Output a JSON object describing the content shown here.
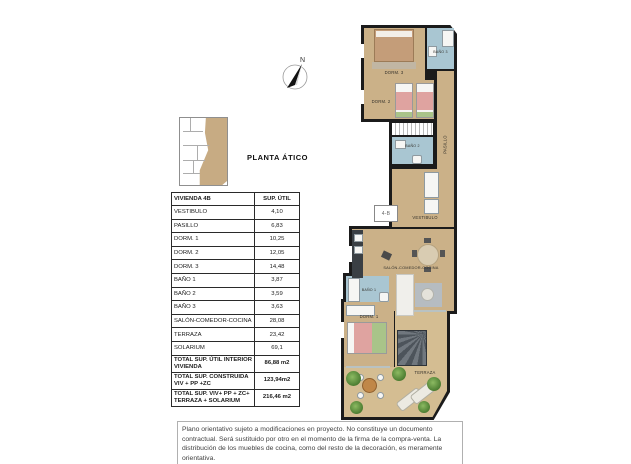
{
  "title": "PLANTA ÁTICO",
  "floorplan": {
    "compass_label": "N",
    "unit_label": "4-B",
    "rooms": {
      "dorm3": "DORM. 3",
      "bano3": "BAÑO 3",
      "dorm2": "DORM. 2",
      "bano2": "BAÑO 2",
      "pasillo": "PASILLO",
      "vestibulo": "VESTIBULO",
      "salon": "SALÓN-COMEDOR-COCINA",
      "bano1": "BAÑO 1",
      "dorm1": "DORM. 1",
      "terraza": "TERRAZA"
    },
    "colors": {
      "wall": "#1b1b1b",
      "wood": "#cbb188",
      "terrace": "#d4bd92",
      "bath": "#a9c6d2",
      "bed-pink": "#dfa3a0",
      "bed-green": "#a9c489",
      "bed-tan": "#c49d79",
      "stair": "#4d545b",
      "key-tan": "#c7ab83"
    }
  },
  "table": {
    "header": {
      "name": "VIVIENDA 4B",
      "value": "SUP. ÚTIL"
    },
    "rows": [
      {
        "label": "VESTIBULO",
        "value": "4,10"
      },
      {
        "label": "PASILLO",
        "value": "6,83"
      },
      {
        "label": "DORM. 1",
        "value": "10,25"
      },
      {
        "label": "DORM. 2",
        "value": "12,05"
      },
      {
        "label": "DORM. 3",
        "value": "14,48"
      },
      {
        "label": "BAÑO 1",
        "value": "3,87"
      },
      {
        "label": "BAÑO 2",
        "value": "3,59"
      },
      {
        "label": "BAÑO 3",
        "value": "3,63"
      },
      {
        "label": "SALÓN-COMEDOR-COCINA",
        "value": "28,08"
      },
      {
        "label": "TERRAZA",
        "value": "23,42"
      },
      {
        "label": "SOLARIUM",
        "value": "69,1"
      }
    ],
    "totals": [
      {
        "label": "TOTAL SUP. ÚTIL INTERIOR VIVIENDA",
        "value": "86,88 m2"
      },
      {
        "label": "TOTAL SUP. CONSTRUIDA VIV + PP +ZC",
        "value": "123,94m2"
      },
      {
        "label": "TOTAL SUP. VIV+ PP + ZC+ TERRAZA + SOLARIUM",
        "value": "216,46 m2"
      }
    ]
  },
  "disclaimer": {
    "text": "Plano orientativo sujeto a modificaciones en proyecto. No constituye un documento contractual. Será sustituido por otro en el momento de la firma de la compra-venta. La distribución de los muebles de cocina, como del resto de la decoración, es meramente orientativa."
  }
}
